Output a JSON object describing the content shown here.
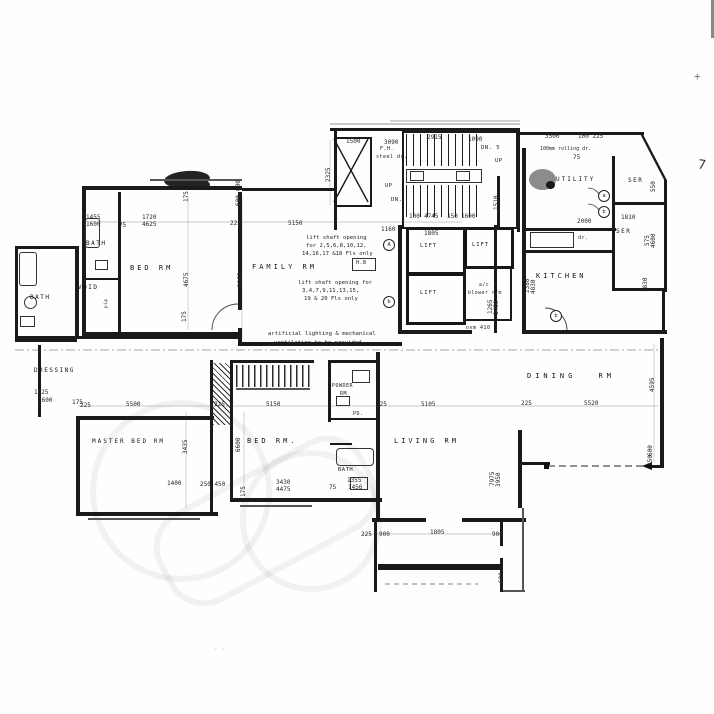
{
  "rooms": {
    "bath_outer": "BATH",
    "bath_inner": "BATH",
    "void": "VOID",
    "bed_rm_1": "BED RM",
    "family_rm": "FAMILY RM",
    "dressing": "DRESSING",
    "master_bed_rm": "MASTER BED RM",
    "bed_rm_2": "BED RM.",
    "powder_l1": "POWDER",
    "powder_l2": "RM",
    "bath_lower": "BATH",
    "living_rm": "LIVING RM",
    "dining_rm": "DINING RM",
    "kitchen": "KITCHEN",
    "utility": "UTILITY",
    "ser_upper": "SER",
    "ser_lower": "SER",
    "lift_a": "LIFT",
    "lift_b": "LIFT",
    "lift_c": "LIFT",
    "ac_l1": "a/c",
    "ac_l2": "blower r/m",
    "hb": "H.B",
    "pd": "PD."
  },
  "core": {
    "up_left": "UP",
    "dn_left": "DN.",
    "up_right": "UP",
    "dn_right": "DN. 5",
    "fh": "F.H.",
    "steel_dr": "steel dr.",
    "dr": "dr.",
    "pip": "pip",
    "ovm": "ovm 410"
  },
  "notes": {
    "lift1_l1": "lift shaft opening",
    "lift1_l2": "for 2,5,6,8,10,12,",
    "lift1_l3": "14,16,17 &18 Fls only",
    "lift2_l1": "lift shaft opening for",
    "lift2_l2": "3,4,7,9,11,13,15,",
    "lift2_l3": "19 & 20 Fls only",
    "vent_l1": "artificial lighting & mechanical",
    "vent_l2": "ventilation to be provided",
    "rolling": "100mm rolling dr."
  },
  "tags": {
    "a_utility": "a",
    "b_utility": "b",
    "a_lobby": "A",
    "b_family": "b",
    "b_kitchen": "b"
  },
  "dims": {
    "d01": "1500",
    "d02": "3090",
    "d03": "2915",
    "d04": "1090",
    "d05": "3500",
    "d06": "100 225",
    "d07": "2325",
    "d08": "600",
    "d09": "600",
    "d10": "1455",
    "d11": "1600",
    "d12": "75",
    "d13": "1720",
    "d14": "4625",
    "d15": "225",
    "d16": "5150",
    "d17": "1160",
    "d18": "100",
    "d19": "4745",
    "d20": "150",
    "d21": "1600",
    "d22": "1805",
    "d23": "2000",
    "d24": "1810",
    "d25": "550",
    "d26": "575",
    "d27": "4600",
    "d28": "175",
    "d29": "4675",
    "d30": "3955",
    "d31": "175",
    "d32": "1510",
    "d33": "2380",
    "d34": "4830",
    "d35": "1830",
    "d36": "1265",
    "d37": "1400",
    "d38": "75",
    "d39": "225",
    "d40": "5500",
    "d41": "225",
    "d42": "5150",
    "d43": "225",
    "d44": "5105",
    "d45": "225",
    "d46": "5520",
    "d47": "4595",
    "d48": "3435",
    "d49": "6600",
    "d50": "1400",
    "d51": "250 450",
    "d52": "3430",
    "d53": "4475",
    "d54": "75",
    "d55": "1355",
    "d56": "1456",
    "d57": "175",
    "d58": "7975",
    "d59": "3950",
    "d60": "225",
    "d61": "900",
    "d62": "1805",
    "d63": "900",
    "d64": "600",
    "d65": "1725",
    "d66": "1600",
    "d67": "175",
    "d68": "600",
    "d69": "150"
  },
  "artifacts": {
    "plus": "+",
    "seven": "7",
    "dots": "· ·"
  }
}
